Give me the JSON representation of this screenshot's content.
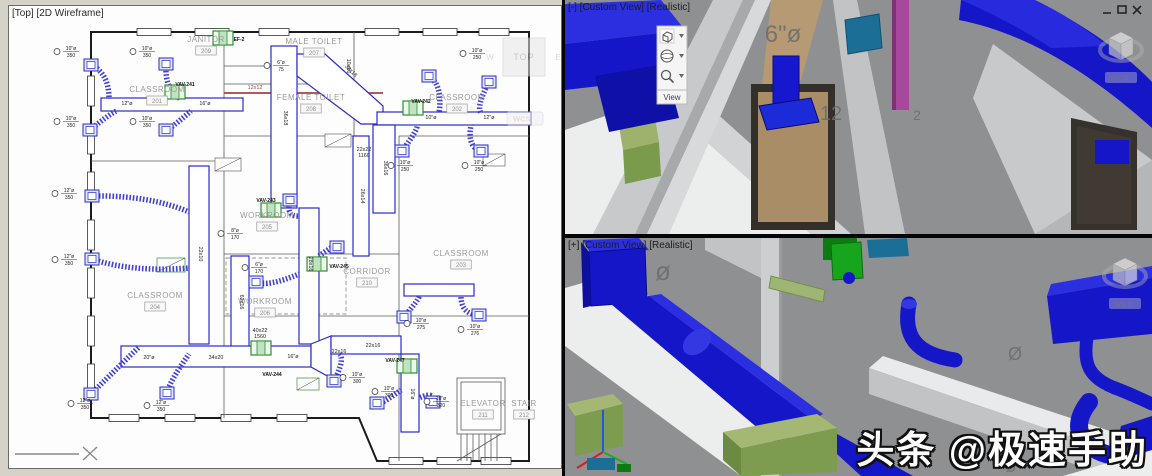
{
  "colors": {
    "plan_blue": "#2a2ac8",
    "plan_green": "#2e8f2e",
    "plan_red": "#a04545",
    "duct_blue": "#1416c8",
    "duct_blue_light": "#2b2fe0",
    "duct_blue_dark": "#0b0b8a",
    "olive": "#7e9c50",
    "olive_light": "#a4b873",
    "machine_green": "#18a51e",
    "teal": "#1b6f96",
    "magenta": "#a8489c",
    "tan": "#b69a73",
    "bg_3d": "#8e9092",
    "floor_white": "#eceded",
    "wall_light": "#c8c9cb"
  },
  "watermark": "头条 @极速手助",
  "viewports": {
    "plan": {
      "label": "[Top] [2D Wireframe]",
      "viewcube": {
        "face": "TOP",
        "west": "W",
        "east": "E",
        "coord_system": "WCS"
      }
    },
    "top3d": {
      "label": "[-] [Custom View] [Realistic]",
      "coord_system": "WCS",
      "view_toolbar": {
        "label": "View"
      },
      "window_buttons": {
        "minimize": "minimize",
        "maximize": "maximize",
        "close": "close"
      },
      "annotations": [
        {
          "text": "6\"ø",
          "x": 218,
          "y": 42,
          "size": 24
        },
        {
          "text": "12",
          "x": 266,
          "y": 120,
          "size": 20
        },
        {
          "text": "2",
          "x": 352,
          "y": 120,
          "size": 14
        }
      ]
    },
    "bottom3d": {
      "label": "[+] [Custom View] [Realistic]",
      "coord_system": "WCS",
      "annotations": [
        {
          "text": "ø",
          "x": 98,
          "y": 42,
          "size": 26
        },
        {
          "text": "Ø",
          "x": 450,
          "y": 122,
          "size": 18
        },
        {
          "text": "8",
          "x": 556,
          "y": 218,
          "size": 30
        },
        {
          "text": "ø",
          "x": 446,
          "y": 234,
          "size": 18
        }
      ]
    }
  },
  "plan": {
    "rooms": [
      {
        "name": "CLASSROOM",
        "num": "201",
        "x": 148,
        "y": 86
      },
      {
        "name": "CLASSROOM",
        "num": "202",
        "x": 448,
        "y": 94
      },
      {
        "name": "CLASSROOM",
        "num": "203",
        "x": 452,
        "y": 250
      },
      {
        "name": "CLASSROOM",
        "num": "204",
        "x": 146,
        "y": 292
      },
      {
        "name": "WORKROOM",
        "num": "205",
        "x": 258,
        "y": 212
      },
      {
        "name": "WORKROOM",
        "num": "206",
        "x": 256,
        "y": 298
      },
      {
        "name": "JANITOR",
        "num": "209",
        "x": 197,
        "y": 36
      },
      {
        "name": "MALE TOILET",
        "num": "207",
        "x": 305,
        "y": 38
      },
      {
        "name": "FEMALE TOILET",
        "num": "208",
        "x": 302,
        "y": 94
      },
      {
        "name": "CORRIDOR",
        "num": "210",
        "x": 358,
        "y": 268
      },
      {
        "name": "ELEVATOR",
        "num": "211",
        "x": 474,
        "y": 400
      },
      {
        "name": "STAIR",
        "num": "212",
        "x": 515,
        "y": 400
      }
    ],
    "duct_labels": [
      {
        "t": "36x18",
        "x": 275,
        "y": 112,
        "r": 90
      },
      {
        "t": "36x18",
        "x": 341,
        "y": 66,
        "r": 45
      },
      {
        "t": "12x12",
        "x": 246,
        "y": 83,
        "r": 0,
        "red": true
      },
      {
        "t": "10x10",
        "x": 338,
        "y": 60,
        "r": 90
      },
      {
        "t": "36x16",
        "x": 375,
        "y": 162,
        "r": 90
      },
      {
        "t": "28x16",
        "x": 300,
        "y": 258,
        "r": 90
      },
      {
        "t": "22x10",
        "x": 190,
        "y": 248,
        "r": 90
      },
      {
        "t": "26x14",
        "x": 352,
        "y": 190,
        "r": 90
      },
      {
        "t": "62x16",
        "x": 231,
        "y": 296,
        "r": 90
      },
      {
        "t": "22x22",
        "x": 355,
        "y": 145,
        "r": 0
      },
      {
        "t": "1160",
        "x": 355,
        "y": 151,
        "r": 0
      },
      {
        "t": "40x22",
        "x": 251,
        "y": 326,
        "r": 0
      },
      {
        "t": "1560",
        "x": 251,
        "y": 332,
        "r": 0
      },
      {
        "t": "20\"ø",
        "x": 140,
        "y": 353,
        "r": 0
      },
      {
        "t": "34x20",
        "x": 207,
        "y": 353,
        "r": 0
      },
      {
        "t": "16\"ø",
        "x": 284,
        "y": 352,
        "r": 0
      },
      {
        "t": "22x16",
        "x": 330,
        "y": 347,
        "r": 0
      },
      {
        "t": "22x16",
        "x": 364,
        "y": 341,
        "r": 0
      },
      {
        "t": "16\"ø",
        "x": 402,
        "y": 388,
        "r": 90
      },
      {
        "t": "12\"ø",
        "x": 118,
        "y": 99,
        "r": 0
      },
      {
        "t": "16\"ø",
        "x": 196,
        "y": 99,
        "r": 0
      },
      {
        "t": "10\"ø",
        "x": 422,
        "y": 113,
        "r": 0
      },
      {
        "t": "12\"ø",
        "x": 480,
        "y": 113,
        "r": 0
      }
    ],
    "callouts": [
      {
        "d": "10\"ø",
        "f": "350",
        "x": 58,
        "y": 44
      },
      {
        "d": "10\"ø",
        "f": "350",
        "x": 134,
        "y": 44
      },
      {
        "d": "10\"ø",
        "f": "350",
        "x": 58,
        "y": 114
      },
      {
        "d": "10\"ø",
        "f": "350",
        "x": 134,
        "y": 114
      },
      {
        "d": "12\"ø",
        "f": "350",
        "x": 56,
        "y": 186
      },
      {
        "d": "12\"ø",
        "f": "350",
        "x": 56,
        "y": 252
      },
      {
        "d": "12\"ø",
        "f": "350",
        "x": 72,
        "y": 396
      },
      {
        "d": "12\"ø",
        "f": "350",
        "x": 148,
        "y": 398
      },
      {
        "d": "6\"ø",
        "f": "75",
        "x": 268,
        "y": 58
      },
      {
        "d": "10\"ø",
        "f": "250",
        "x": 464,
        "y": 46
      },
      {
        "d": "10\"ø",
        "f": "250",
        "x": 392,
        "y": 158
      },
      {
        "d": "10\"ø",
        "f": "250",
        "x": 466,
        "y": 158
      },
      {
        "d": "10\"ø",
        "f": "275",
        "x": 408,
        "y": 316
      },
      {
        "d": "10\"ø",
        "f": "276",
        "x": 462,
        "y": 322
      },
      {
        "d": "8\"ø",
        "f": "170",
        "x": 222,
        "y": 226
      },
      {
        "d": "6\"ø",
        "f": "170",
        "x": 246,
        "y": 260
      },
      {
        "d": "10\"ø",
        "f": "300",
        "x": 344,
        "y": 370
      },
      {
        "d": "10\"ø",
        "f": "300",
        "x": 376,
        "y": 384
      },
      {
        "d": "10\"ø",
        "f": "320",
        "x": 428,
        "y": 394
      }
    ],
    "vavs": [
      {
        "label": "VAV-241",
        "x": 166,
        "y": 86,
        "lx": 176,
        "ly": 80
      },
      {
        "label": "VAV-242",
        "x": 404,
        "y": 102,
        "lx": 412,
        "ly": 97
      },
      {
        "label": "VAV-243",
        "x": 262,
        "y": 204,
        "lx": 257,
        "ly": 196
      },
      {
        "label": "VAV-245",
        "x": 308,
        "y": 258,
        "lx": 330,
        "ly": 262
      },
      {
        "label": "VAV-244",
        "x": 252,
        "y": 342,
        "lx": 263,
        "ly": 370
      },
      {
        "label": "VAV-247",
        "x": 398,
        "y": 360,
        "lx": 386,
        "ly": 356
      },
      {
        "label": "EF-2",
        "x": 214,
        "y": 32,
        "lx": 230,
        "ly": 35
      }
    ],
    "diffusers": [
      {
        "x": 82,
        "y": 59,
        "tx": 100,
        "ty": 93
      },
      {
        "x": 157,
        "y": 58,
        "tx": 172,
        "ty": 93
      },
      {
        "x": 81,
        "y": 124,
        "tx": 108,
        "ty": 105
      },
      {
        "x": 157,
        "y": 124,
        "tx": 182,
        "ty": 105
      },
      {
        "x": 83,
        "y": 190,
        "tx": 180,
        "ty": 206
      },
      {
        "x": 83,
        "y": 253,
        "tx": 180,
        "ty": 262
      },
      {
        "x": 82,
        "y": 388,
        "tx": 130,
        "ty": 341
      },
      {
        "x": 158,
        "y": 387,
        "tx": 180,
        "ty": 348
      },
      {
        "x": 420,
        "y": 70,
        "tx": 430,
        "ty": 107
      },
      {
        "x": 480,
        "y": 76,
        "tx": 472,
        "ty": 107
      },
      {
        "x": 393,
        "y": 145,
        "tx": 408,
        "ty": 119
      },
      {
        "x": 472,
        "y": 145,
        "tx": 462,
        "ty": 119
      },
      {
        "x": 395,
        "y": 311,
        "tx": 410,
        "ty": 290
      },
      {
        "x": 470,
        "y": 309,
        "tx": 452,
        "ty": 290
      },
      {
        "x": 325,
        "y": 375,
        "tx": 330,
        "ty": 348
      },
      {
        "x": 368,
        "y": 397,
        "tx": 392,
        "ty": 384
      },
      {
        "x": 424,
        "y": 396,
        "tx": 410,
        "ty": 392
      },
      {
        "x": 281,
        "y": 194,
        "tx": 290,
        "ty": 210
      },
      {
        "x": 328,
        "y": 241,
        "tx": 310,
        "ty": 250
      },
      {
        "x": 247,
        "y": 276,
        "tx": 290,
        "ty": 268
      }
    ]
  }
}
